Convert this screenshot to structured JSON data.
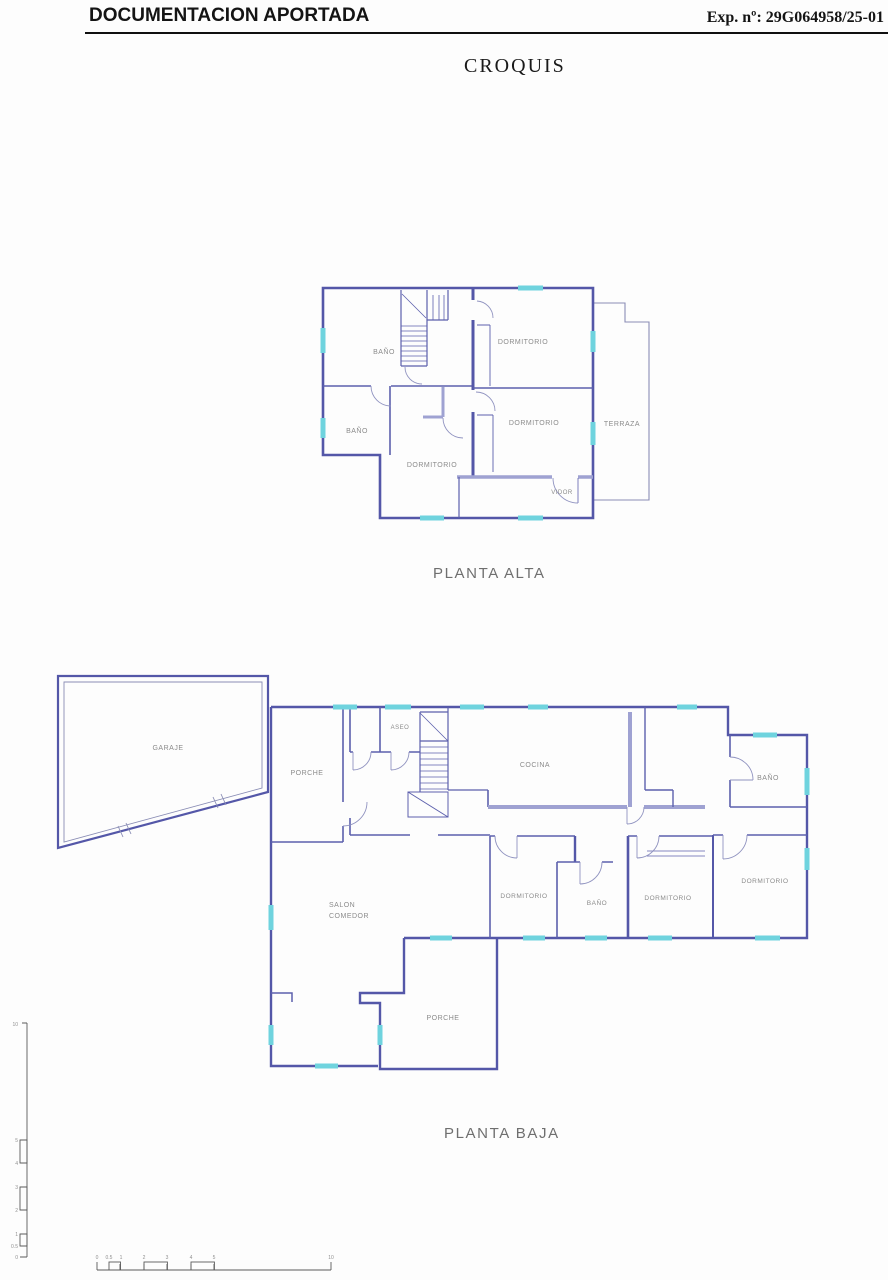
{
  "header": {
    "title": "DOCUMENTACION APORTADA",
    "exp": "Exp. nº: 29G064958/25-01"
  },
  "doc_title": "CROQUIS",
  "planta_alta": {
    "caption": "PLANTA ALTA",
    "rooms": {
      "bano_top": "BAÑO",
      "dormitorio_top": "DORMITORIO",
      "bano_mid": "BAÑO",
      "dormitorio_mid": "DORMITORIO",
      "dormitorio_bottom": "DORMITORIO",
      "terraza": "TERRAZA",
      "vidor": "VIDOR"
    }
  },
  "planta_baja": {
    "caption": "PLANTA BAJA",
    "rooms": {
      "garaje": "GARAJE",
      "porche_top": "PORCHE",
      "aseo": "ASEO",
      "cocina": "COCINA",
      "bano_top": "BAÑO",
      "salon_line1": "SALON",
      "salon_line2": "COMEDOR",
      "dormitorio_left": "DORMITORIO",
      "bano_bottom": "BAÑO",
      "dormitorio_mid": "DORMITORIO",
      "dormitorio_right": "DORMITORIO",
      "porche_bottom": "PORCHE"
    }
  },
  "scale_bar": {
    "h_labels": [
      "0",
      "0.5",
      "1",
      "2",
      "3",
      "4",
      "5",
      "10"
    ],
    "v_labels": [
      "10",
      "5",
      "4",
      "3",
      "2",
      "1",
      "0.5",
      "0"
    ]
  },
  "colors": {
    "wall": "#5457a8",
    "wall_thick": "#9fa2d2",
    "window": "#6fd3de",
    "room_label": "#8b8b8b",
    "caption": "#6f6f6f",
    "header_text": "#141414"
  }
}
